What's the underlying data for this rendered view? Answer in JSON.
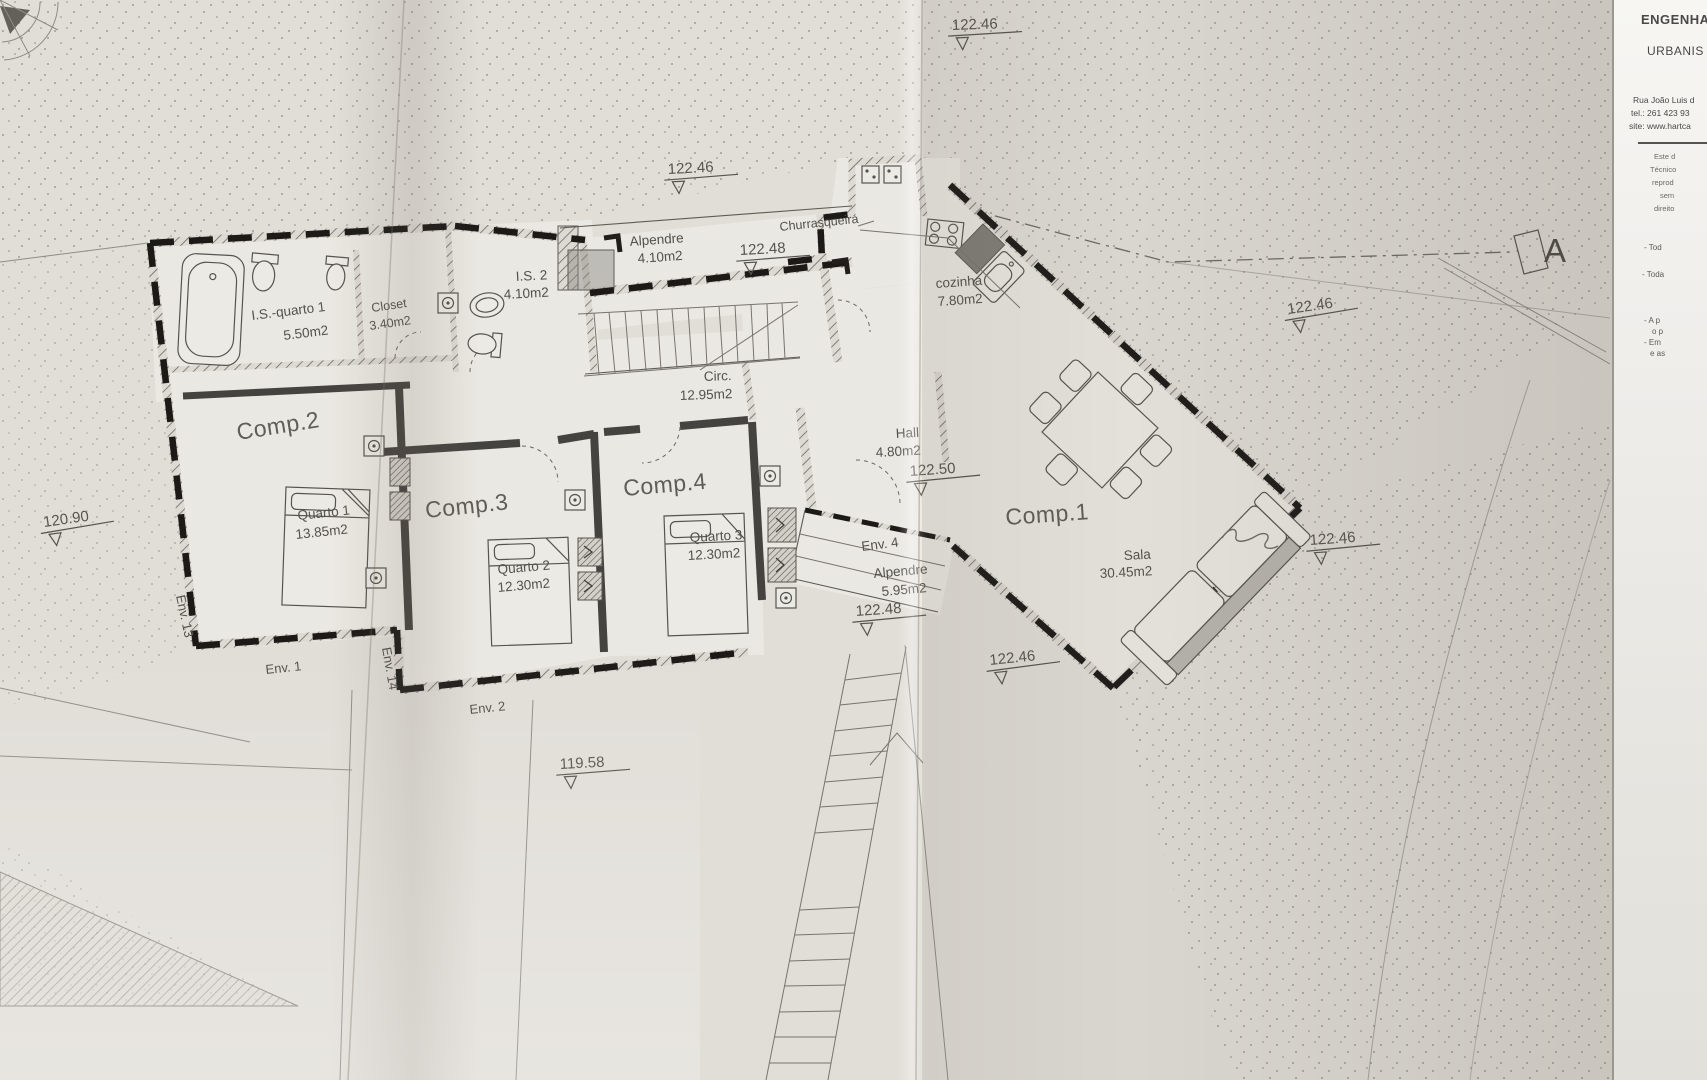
{
  "sheet": {
    "section_label": "A",
    "levels": {
      "top": "122.46",
      "upper_mid": "122.46",
      "alpendre": "122.48",
      "upper_right": "122.46",
      "hall": "122.50",
      "env4": "122.48",
      "right": "122.46",
      "below_sala": "122.46",
      "left": "120.90",
      "bottom": "119.58"
    },
    "rooms": {
      "alpendre_top": {
        "name": "Alpendre",
        "area": "4.10m2"
      },
      "churrasqueira": {
        "name": "Churrasqueira"
      },
      "is2": {
        "name": "I.S. 2",
        "area": "4.10m2"
      },
      "closet": {
        "name": "Closet",
        "area": "3.40m2"
      },
      "is_quarto1": {
        "name": "I.S.-quarto 1",
        "area": "5.50m2"
      },
      "cozinha": {
        "name": "cozinha",
        "area": "7.80m2"
      },
      "circ": {
        "name": "Circ.",
        "area": "12.95m2"
      },
      "hall": {
        "name": "Hall",
        "area": "4.80m2"
      },
      "comp1": {
        "name": "Comp.1"
      },
      "sala": {
        "name": "Sala",
        "area": "30.45m2"
      },
      "comp2": {
        "name": "Comp.2"
      },
      "quarto1": {
        "name": "Quarto 1",
        "area": "13.85m2"
      },
      "comp3": {
        "name": "Comp.3"
      },
      "quarto2": {
        "name": "Quarto 2",
        "area": "12.30m2"
      },
      "comp4": {
        "name": "Comp.4"
      },
      "quarto3": {
        "name": "Quarto 3",
        "area": "12.30m2"
      },
      "env4": {
        "name": "Env. 4"
      },
      "alpendre_side": {
        "name": "Alpendre",
        "area": "5.95m2"
      }
    },
    "envelopes": {
      "env13": "Env. 13",
      "env1": "Env. 1",
      "env14": "Env. 14",
      "env2": "Env. 2"
    }
  },
  "title_block": {
    "discipline1": "ENGENHA",
    "discipline2": "URBANIS",
    "address": "Rua João Luis d",
    "tel": "tel.: 261 423 93",
    "site": "site: www.hartca",
    "notice": [
      "Este d",
      "Técnico",
      "reprod",
      "sem",
      "direito"
    ],
    "notes": [
      "- Tod",
      "- Toda",
      "- A p",
      "o p",
      "- Em",
      "e as"
    ]
  }
}
